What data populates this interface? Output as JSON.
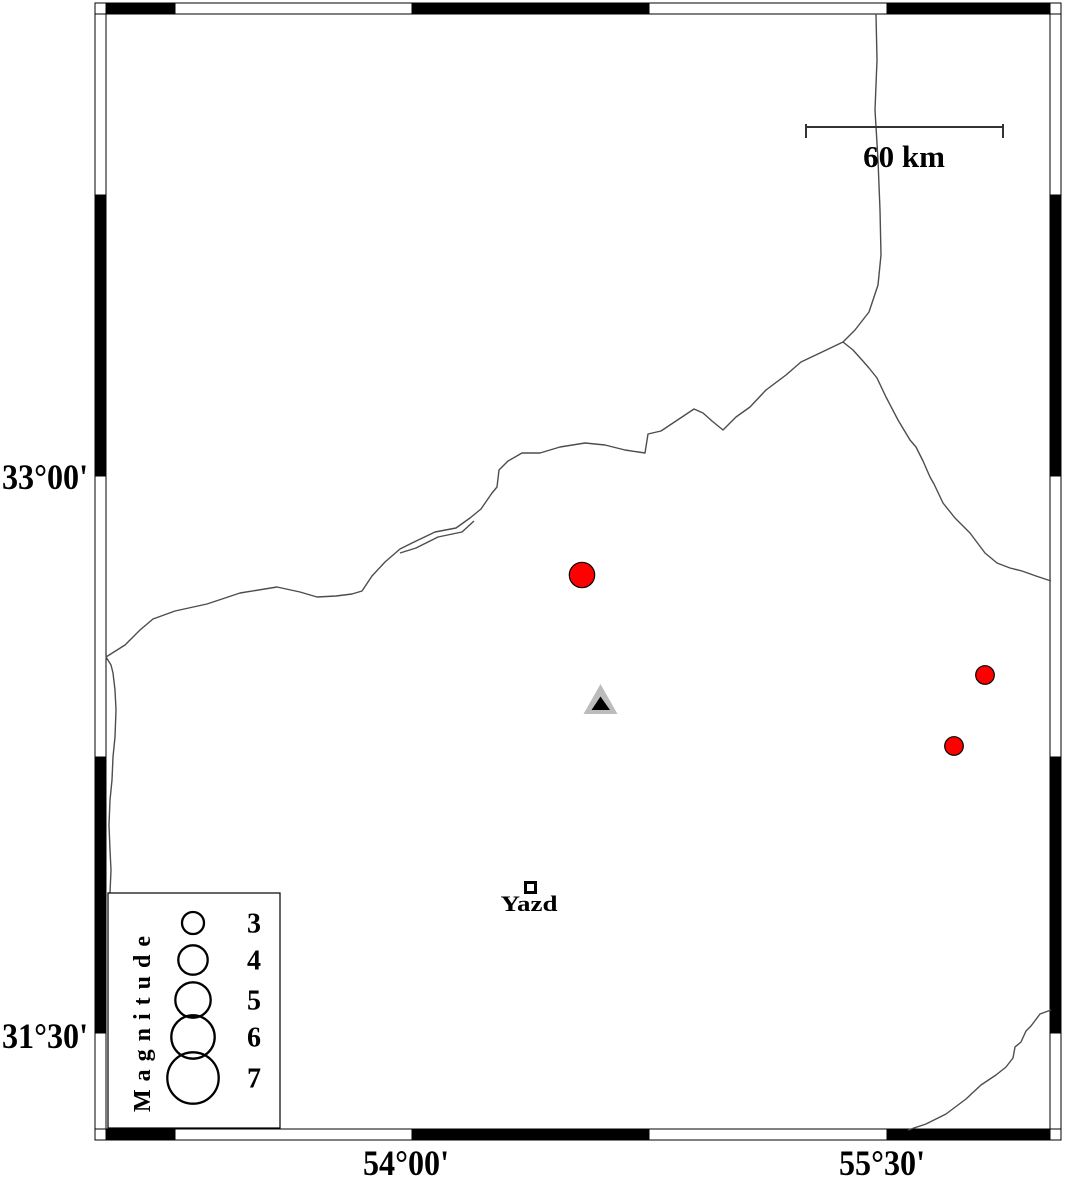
{
  "figure": {
    "background": "#ffffff"
  },
  "frame": {
    "black": "#000000",
    "white": "#ffffff",
    "top_y": 3,
    "bottom_y": 1129,
    "left_x": 95,
    "right_x": 1050,
    "thickness": 11,
    "h_cells": [
      {
        "x": 106,
        "w": 69,
        "fill": "black"
      },
      {
        "x": 175,
        "w": 237,
        "fill": "white"
      },
      {
        "x": 412,
        "w": 237,
        "fill": "black"
      },
      {
        "x": 649,
        "w": 238,
        "fill": "white"
      },
      {
        "x": 887,
        "w": 163,
        "fill": "black"
      }
    ],
    "v_cells": [
      {
        "y": 14,
        "h": 181,
        "fill": "white"
      },
      {
        "y": 195,
        "h": 281,
        "fill": "black"
      },
      {
        "y": 476,
        "h": 281,
        "fill": "white"
      },
      {
        "y": 757,
        "h": 276,
        "fill": "black"
      },
      {
        "y": 1033,
        "h": 96,
        "fill": "white"
      }
    ],
    "corners": [
      {
        "x": 95,
        "y": 3
      },
      {
        "x": 1050,
        "y": 3
      },
      {
        "x": 95,
        "y": 1129
      },
      {
        "x": 1050,
        "y": 1129
      }
    ]
  },
  "axis": {
    "left_labels": [
      {
        "text": "33°00'",
        "x": 88,
        "y": 489
      },
      {
        "text": "31°30'",
        "x": 88,
        "y": 1048
      }
    ],
    "bottom_labels": [
      {
        "text": "54°00'",
        "x": 406,
        "y": 1175
      },
      {
        "text": "55°30'",
        "x": 882,
        "y": 1175
      }
    ]
  },
  "scale_bar": {
    "label": "60 km",
    "x1": 806,
    "x2": 1003,
    "y": 127,
    "tick_y1": 124,
    "tick_y2": 138,
    "label_x": 904,
    "label_y": 167,
    "color": "#333333"
  },
  "boundary_lines": {
    "color": "#4d4d4d",
    "width": 1.4,
    "paths": {
      "main_border": [
        [
          106,
          657
        ],
        [
          125,
          645
        ],
        [
          140,
          630
        ],
        [
          153,
          619
        ],
        [
          175,
          611
        ],
        [
          207,
          604
        ],
        [
          240,
          593
        ],
        [
          277,
          587
        ],
        [
          300,
          592
        ],
        [
          317,
          597
        ],
        [
          336,
          596
        ],
        [
          352,
          594
        ],
        [
          362,
          591
        ],
        [
          372,
          576
        ],
        [
          385,
          562
        ],
        [
          400,
          549
        ],
        [
          412,
          543
        ],
        [
          435,
          532
        ],
        [
          456,
          528
        ],
        [
          470,
          518
        ],
        [
          481,
          509
        ],
        [
          492,
          493
        ],
        [
          497,
          487
        ],
        [
          499,
          470
        ],
        [
          508,
          461
        ],
        [
          522,
          453
        ],
        [
          540,
          453
        ],
        [
          560,
          447
        ],
        [
          585,
          443
        ],
        [
          605,
          445
        ],
        [
          625,
          450
        ],
        [
          645,
          453
        ],
        [
          648,
          434
        ],
        [
          661,
          431
        ],
        [
          676,
          421
        ],
        [
          694,
          409
        ],
        [
          703,
          413
        ],
        [
          712,
          421
        ],
        [
          723,
          430
        ],
        [
          736,
          417
        ],
        [
          750,
          407
        ],
        [
          766,
          390
        ],
        [
          786,
          375
        ],
        [
          801,
          362
        ],
        [
          820,
          353
        ],
        [
          843,
          342
        ],
        [
          853,
          350
        ],
        [
          862,
          360
        ],
        [
          869,
          368
        ],
        [
          877,
          378
        ],
        [
          886,
          397
        ],
        [
          898,
          420
        ],
        [
          910,
          440
        ],
        [
          916,
          447
        ],
        [
          923,
          461
        ],
        [
          930,
          477
        ],
        [
          934,
          484
        ],
        [
          943,
          503
        ],
        [
          955,
          518
        ],
        [
          970,
          533
        ],
        [
          985,
          553
        ],
        [
          997,
          563
        ],
        [
          1010,
          568
        ],
        [
          1022,
          571
        ],
        [
          1036,
          576
        ],
        [
          1051,
          581
        ]
      ],
      "north_road": [
        [
          876,
          14
        ],
        [
          877,
          60
        ],
        [
          875,
          110
        ],
        [
          878,
          160
        ],
        [
          880,
          210
        ],
        [
          881,
          255
        ],
        [
          878,
          285
        ],
        [
          869,
          312
        ],
        [
          855,
          330
        ],
        [
          843,
          342
        ]
      ],
      "west_edge": [
        [
          106,
          657
        ],
        [
          111,
          665
        ],
        [
          113,
          673
        ],
        [
          115,
          690
        ],
        [
          116,
          710
        ],
        [
          115,
          737
        ],
        [
          113,
          757
        ],
        [
          112,
          780
        ],
        [
          110,
          800
        ],
        [
          109,
          825
        ],
        [
          110,
          850
        ],
        [
          111,
          870
        ],
        [
          110,
          893
        ]
      ],
      "southeast": [
        [
          1051,
          1010
        ],
        [
          1040,
          1014
        ],
        [
          1031,
          1026
        ],
        [
          1026,
          1031
        ],
        [
          1021,
          1042
        ],
        [
          1015,
          1047
        ],
        [
          1013,
          1058
        ],
        [
          1006,
          1067
        ],
        [
          996,
          1075
        ],
        [
          981,
          1085
        ],
        [
          966,
          1099
        ],
        [
          946,
          1114
        ],
        [
          926,
          1124
        ],
        [
          908,
          1130
        ]
      ],
      "double_echo": [
        [
          400,
          553
        ],
        [
          416,
          548
        ],
        [
          438,
          537
        ],
        [
          462,
          532
        ],
        [
          474,
          521
        ]
      ]
    }
  },
  "earthquakes": {
    "fill": "#ff0000",
    "stroke": "#000000",
    "points": [
      {
        "cx": 582,
        "cy": 575,
        "r": 12.7
      },
      {
        "cx": 985,
        "cy": 675,
        "r": 9.3
      },
      {
        "cx": 954,
        "cy": 746,
        "r": 9.3
      }
    ]
  },
  "station": {
    "outer_fill": "#bcbcbc",
    "inner_fill": "#000000",
    "outer_points": "600.5,684 583.5,714 617.5,714",
    "inner_points": "600.5,696.5 591.5,710 610,710"
  },
  "city": {
    "name": "Yazd",
    "marker": {
      "x": 525.5,
      "y": 882.5,
      "size": 10
    },
    "label_x": 529,
    "label_y": 911
  },
  "legend": {
    "title": "Magnitude",
    "box": {
      "x": 108,
      "y": 893,
      "w": 172,
      "h": 235
    },
    "circle_cx": 193,
    "label_x": 254,
    "items": [
      {
        "label": "3",
        "cy": 923,
        "r": 11
      },
      {
        "label": "4",
        "cy": 960,
        "r": 14.7
      },
      {
        "label": "5",
        "cy": 1000,
        "r": 17.7
      },
      {
        "label": "6",
        "cy": 1037,
        "r": 21.7
      },
      {
        "label": "7",
        "cy": 1078,
        "r": 25.7
      }
    ]
  }
}
